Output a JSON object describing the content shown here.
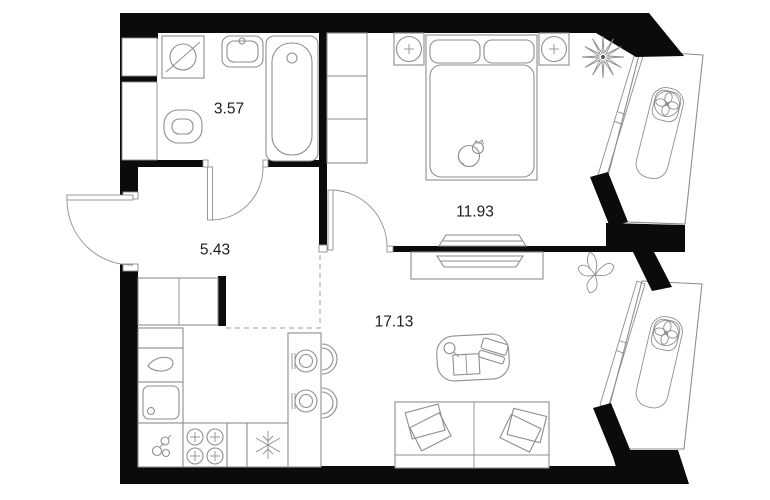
{
  "floor_plan": {
    "rooms": [
      {
        "id": "bathroom",
        "area": "3.57"
      },
      {
        "id": "hallway",
        "area": "5.43"
      },
      {
        "id": "bedroom",
        "area": "11.93"
      },
      {
        "id": "living-room",
        "area": "17.13"
      }
    ],
    "fixtures": [
      "washing-machine",
      "bathroom-sink",
      "bathtub",
      "toilet",
      "duct-shaft",
      "entrance-door",
      "interior-door",
      "hall-wardrobe",
      "kitchen-counter",
      "kitchen-sink",
      "stove",
      "fridge",
      "dining-table",
      "chair",
      "plate-setting",
      "double-bed",
      "pillow",
      "cat",
      "nightstand-lamp",
      "wardrobe",
      "tv",
      "tv-stand",
      "coffee-table",
      "laptop",
      "book",
      "sofa",
      "plant",
      "window-glazing",
      "balcony",
      "air-conditioner-fan",
      "snowflake"
    ]
  },
  "colors": {
    "wall": "#0b0b0b",
    "line": "#8e8e8e",
    "dash": "#b0b0b0",
    "text": "#1c1c1c",
    "bg": "#ffffff"
  }
}
